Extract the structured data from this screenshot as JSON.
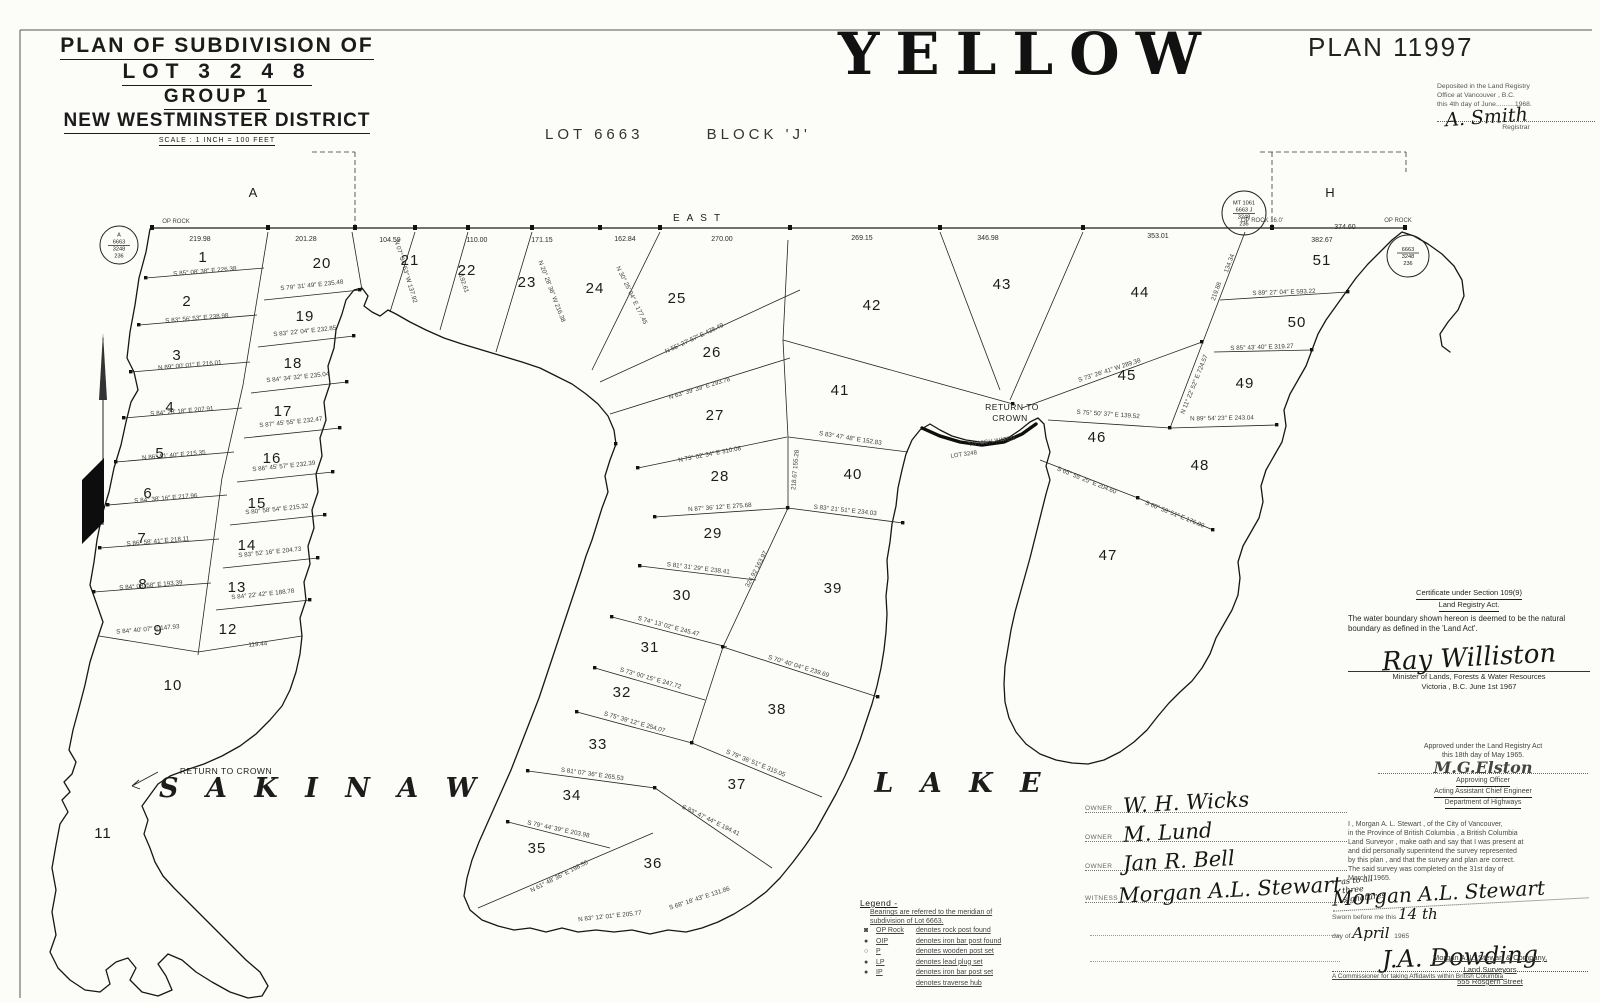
{
  "header": {
    "title_line1": "PLAN  OF  SUBDIVISION  OF",
    "title_line2": "LOT  3 2 4 8",
    "title_line3": "GROUP 1",
    "title_line4": "NEW WESTMINSTER DISTRICT",
    "scale": "SCALE : 1 INCH = 100 FEET",
    "big_title": "YELLOW",
    "plan_number": "PLAN 11997",
    "lot_label": "LOT  6663",
    "block_label": "BLOCK  'J'"
  },
  "deposit": {
    "line1": "Deposited in the Land Registry",
    "line2": "Office  at  Vancouver ,  B.C.",
    "line3": "this 4th day of June..........1968.",
    "signature": "A. Smith",
    "role": "Registrar"
  },
  "certificate": {
    "line1": "Certificate under Section 109(9)",
    "line2": "Land Registry Act.",
    "body": "The water boundary shown hereon is deemed to be the natural boundary as defined in the 'Land Act'.",
    "signature": "Ray Williston",
    "role1": "Minister of Lands, Forests & Water Resources",
    "location_date": "Victoria , B.C.        June 1st        1967"
  },
  "approval": {
    "line1": "Approved under the Land Registry Act",
    "line2": "this 18th day of May 1965.",
    "signature": "M.G.Elston",
    "role1": "Approving Officer",
    "role2": "Acting Assistant Chief Engineer",
    "role3": "Department of Highways"
  },
  "owners": {
    "rows": [
      {
        "label": "OWNER",
        "name": "W. H. Wicks",
        "note": ""
      },
      {
        "label": "OWNER",
        "name": "M. Lund",
        "note": ""
      },
      {
        "label": "OWNER",
        "name": "Jan R. Bell",
        "note": ""
      },
      {
        "label": "WITNESS",
        "name": "Morgan A.L. Stewart",
        "note": "as to all three signatures"
      }
    ]
  },
  "affidavit": {
    "lines": [
      "I , Morgan A. L. Stewart , of the City of  Vancouver,",
      "in the Province  of British Columbia , a British Columbia",
      "Land Surveyor , make oath and say  that I was present at",
      "and did personally  superintend  the  survey  represented",
      "by this plan , and that the survey and plan are correct.",
      "The said survey  was  completed  on  the  31st  day of",
      "March  ,  1965."
    ]
  },
  "sworn": {
    "surveyor_signature": "Morgan A.L. Stewart",
    "line1": "Sworn before me this ",
    "date_script": "14 th",
    "line2": "day of ",
    "month_script": "April",
    "year": " 1965",
    "signature": "J.A. Dowding",
    "commissioner": "A Commissioner for taking Affidavits within British Columbia"
  },
  "company": {
    "line1": "Morgan  A. L.  Stewart  &  Company,",
    "line2": "Land  Surveyors",
    "line3": "555   Rosgern   Street"
  },
  "legend": {
    "title": "Legend -",
    "note1": "Bearings are referred to the meridian of",
    "note2": "subdivision  of  Lot 6663.",
    "rows": [
      {
        "sym": "◙",
        "abbr": "OP Rock",
        "text": "denotes rock post found"
      },
      {
        "sym": "●",
        "abbr": "OIP",
        "text": "denotes iron bar post found"
      },
      {
        "sym": "○",
        "abbr": "P",
        "text": "denotes wooden post set"
      },
      {
        "sym": "●",
        "abbr": "LP",
        "text": "denotes lead plug set"
      },
      {
        "sym": "●",
        "abbr": "IP",
        "text": "denotes iron bar post set"
      },
      {
        "sym": "",
        "abbr": "",
        "text": "denotes traverse hub"
      }
    ]
  },
  "map": {
    "ink_color": "#1c1c1c",
    "paper_color": "#fcfcf9",
    "labels": [
      {
        "t": "EAST",
        "x": 700,
        "y": 221,
        "cls": "dir"
      },
      {
        "t": "A",
        "x": 253,
        "y": 197,
        "cls": "big"
      },
      {
        "t": "H",
        "x": 1330,
        "y": 197,
        "cls": "big"
      },
      {
        "t": "S A K I N A W",
        "x": 322,
        "y": 797,
        "cls": "lake"
      },
      {
        "t": "L A K E",
        "x": 962,
        "y": 792,
        "cls": "lake"
      },
      {
        "t": "RETURN TO CROWN",
        "x": 226,
        "y": 774,
        "cls": "rtc"
      },
      {
        "t": "RETURN TO",
        "x": 1012,
        "y": 410,
        "cls": "rtc"
      },
      {
        "t": "CROWN",
        "x": 1010,
        "y": 421,
        "cls": "rtc"
      },
      {
        "t": "TO HIGH WATER",
        "x": 992,
        "y": 443,
        "cls": "tiny",
        "r": -8
      },
      {
        "t": "LOT 3248",
        "x": 964,
        "y": 456,
        "cls": "tiny",
        "r": -8
      },
      {
        "t": "OP ROCK",
        "x": 176,
        "y": 223,
        "cls": "tiny"
      },
      {
        "t": "OP ROCK  16.0'",
        "x": 1262,
        "y": 222,
        "cls": "tiny"
      },
      {
        "t": "OP ROCK",
        "x": 1398,
        "y": 222,
        "cls": "tiny"
      }
    ],
    "lots": [
      {
        "n": 1,
        "x": 203,
        "y": 262
      },
      {
        "n": 2,
        "x": 187,
        "y": 306
      },
      {
        "n": 3,
        "x": 177,
        "y": 360
      },
      {
        "n": 4,
        "x": 170,
        "y": 412
      },
      {
        "n": 5,
        "x": 160,
        "y": 458
      },
      {
        "n": 6,
        "x": 148,
        "y": 498
      },
      {
        "n": 7,
        "x": 142,
        "y": 543
      },
      {
        "n": 8,
        "x": 143,
        "y": 589
      },
      {
        "n": 9,
        "x": 158,
        "y": 635
      },
      {
        "n": 10,
        "x": 173,
        "y": 690
      },
      {
        "n": 11,
        "x": 103,
        "y": 838
      },
      {
        "n": 12,
        "x": 228,
        "y": 634
      },
      {
        "n": 13,
        "x": 237,
        "y": 592
      },
      {
        "n": 14,
        "x": 247,
        "y": 550
      },
      {
        "n": 15,
        "x": 257,
        "y": 508
      },
      {
        "n": 16,
        "x": 272,
        "y": 463
      },
      {
        "n": 17,
        "x": 283,
        "y": 416
      },
      {
        "n": 18,
        "x": 293,
        "y": 368
      },
      {
        "n": 19,
        "x": 305,
        "y": 321
      },
      {
        "n": 20,
        "x": 322,
        "y": 268
      },
      {
        "n": 21,
        "x": 410,
        "y": 265
      },
      {
        "n": 22,
        "x": 467,
        "y": 275
      },
      {
        "n": 23,
        "x": 527,
        "y": 287
      },
      {
        "n": 24,
        "x": 595,
        "y": 293
      },
      {
        "n": 25,
        "x": 677,
        "y": 303
      },
      {
        "n": 26,
        "x": 712,
        "y": 357
      },
      {
        "n": 27,
        "x": 715,
        "y": 420
      },
      {
        "n": 28,
        "x": 720,
        "y": 481
      },
      {
        "n": 29,
        "x": 713,
        "y": 538
      },
      {
        "n": 30,
        "x": 682,
        "y": 600
      },
      {
        "n": 31,
        "x": 650,
        "y": 652
      },
      {
        "n": 32,
        "x": 622,
        "y": 697
      },
      {
        "n": 33,
        "x": 598,
        "y": 749
      },
      {
        "n": 34,
        "x": 572,
        "y": 800
      },
      {
        "n": 35,
        "x": 537,
        "y": 853
      },
      {
        "n": 36,
        "x": 653,
        "y": 868
      },
      {
        "n": 37,
        "x": 737,
        "y": 789
      },
      {
        "n": 38,
        "x": 777,
        "y": 714
      },
      {
        "n": 39,
        "x": 833,
        "y": 593
      },
      {
        "n": 40,
        "x": 853,
        "y": 479
      },
      {
        "n": 41,
        "x": 840,
        "y": 395
      },
      {
        "n": 42,
        "x": 872,
        "y": 310
      },
      {
        "n": 43,
        "x": 1002,
        "y": 289
      },
      {
        "n": 44,
        "x": 1140,
        "y": 297
      },
      {
        "n": 45,
        "x": 1127,
        "y": 380
      },
      {
        "n": 46,
        "x": 1097,
        "y": 442
      },
      {
        "n": 47,
        "x": 1108,
        "y": 560
      },
      {
        "n": 48,
        "x": 1200,
        "y": 470
      },
      {
        "n": 49,
        "x": 1245,
        "y": 388
      },
      {
        "n": 50,
        "x": 1297,
        "y": 327
      },
      {
        "n": 51,
        "x": 1322,
        "y": 265
      }
    ],
    "baseline_distances": [
      {
        "t": "219.98",
        "x": 200,
        "y": 241
      },
      {
        "t": "201.28",
        "x": 306,
        "y": 241
      },
      {
        "t": "104.59",
        "x": 390,
        "y": 242
      },
      {
        "t": "110.00",
        "x": 477,
        "y": 242
      },
      {
        "t": "171.15",
        "x": 542,
        "y": 242
      },
      {
        "t": "162.84",
        "x": 625,
        "y": 241
      },
      {
        "t": "270.00",
        "x": 722,
        "y": 241
      },
      {
        "t": "269.15",
        "x": 862,
        "y": 240
      },
      {
        "t": "346.98",
        "x": 988,
        "y": 240
      },
      {
        "t": "353.01",
        "x": 1158,
        "y": 238
      },
      {
        "t": "382.67",
        "x": 1322,
        "y": 242
      },
      {
        "t": "374.60",
        "x": 1345,
        "y": 229
      }
    ],
    "annotations": [
      {
        "t": "S 85° 08' 38″ E   226.38",
        "x": 205,
        "y": 273,
        "r": -5
      },
      {
        "t": "S 83° 56' 53″ E   238.98",
        "x": 197,
        "y": 320,
        "r": -5
      },
      {
        "t": "N 89° 00' 01″ E   216.01",
        "x": 190,
        "y": 367,
        "r": -5
      },
      {
        "t": "S 84° 28' 18″ E   207.91",
        "x": 182,
        "y": 413,
        "r": -5
      },
      {
        "t": "N 86° 51' 40″ E   215.35",
        "x": 174,
        "y": 457,
        "r": -5
      },
      {
        "t": "S 84° 38' 16″ E   217.96",
        "x": 166,
        "y": 500,
        "r": -5
      },
      {
        "t": "S 86° 58' 41″ E   218.11",
        "x": 158,
        "y": 543,
        "r": -5
      },
      {
        "t": "S 84° 08' 58″ E   193.39",
        "x": 151,
        "y": 587,
        "r": -5
      },
      {
        "t": "S 84° 40' 07″ E   147.93",
        "x": 148,
        "y": 631,
        "r": -5
      },
      {
        "t": "S 79° 31' 49″ E   235.48",
        "x": 312,
        "y": 287,
        "r": -6
      },
      {
        "t": "S 83° 22' 04″ E   232.85",
        "x": 305,
        "y": 333,
        "r": -6
      },
      {
        "t": "S 84° 34' 32″ E   235.04",
        "x": 298,
        "y": 379,
        "r": -6
      },
      {
        "t": "S 87° 45' 55″ E   232.47",
        "x": 291,
        "y": 424,
        "r": -6
      },
      {
        "t": "S 86° 45' 57″ E   232.39",
        "x": 284,
        "y": 468,
        "r": -6
      },
      {
        "t": "S 80° 58' 54″ E   215.32",
        "x": 277,
        "y": 511,
        "r": -6
      },
      {
        "t": "S 83° 52' 16″ E   204.73",
        "x": 270,
        "y": 554,
        "r": -6
      },
      {
        "t": "S 84° 22' 42″ E   188.78",
        "x": 263,
        "y": 596,
        "r": -6
      },
      {
        "t": "119.44",
        "x": 258,
        "y": 646,
        "r": -5
      },
      {
        "t": "N 07° 34' 53″ W  137.92",
        "x": 404,
        "y": 272,
        "r": 73
      },
      {
        "t": "192.61",
        "x": 462,
        "y": 284,
        "r": 71
      },
      {
        "t": "N 20° 28' 36″ W  216.38",
        "x": 550,
        "y": 292,
        "r": 69
      },
      {
        "t": "N 30° 25' 04″ E  177.45",
        "x": 630,
        "y": 296,
        "r": 64
      },
      {
        "t": "N 55° 27' 57″ E   438.49",
        "x": 695,
        "y": 340,
        "r": -25
      },
      {
        "t": "N 63° 39' 39″ E   293.78",
        "x": 700,
        "y": 390,
        "r": -17
      },
      {
        "t": "N 73° 02' 34″ E   310.08",
        "x": 710,
        "y": 456,
        "r": -11
      },
      {
        "t": "N 87° 36' 12″ E   275.68",
        "x": 720,
        "y": 509,
        "r": -4
      },
      {
        "t": "S 81° 31' 29″ E   238.41",
        "x": 698,
        "y": 570,
        "r": 7
      },
      {
        "t": "S 74° 13' 02″ E   245.47",
        "x": 668,
        "y": 628,
        "r": 15
      },
      {
        "t": "S 73° 00' 15″ E   247.72",
        "x": 650,
        "y": 680,
        "r": 16
      },
      {
        "t": "S 75° 39' 12″ E   254.07",
        "x": 634,
        "y": 724,
        "r": 16
      },
      {
        "t": "S 81° 07' 36″ E   265.53",
        "x": 592,
        "y": 776,
        "r": 8
      },
      {
        "t": "S 79° 44' 39″ E   203.98",
        "x": 558,
        "y": 831,
        "r": 12
      },
      {
        "t": "N 61° 48' 36″ E   198.56",
        "x": 560,
        "y": 878,
        "r": -27
      },
      {
        "t": "N 83° 12' 01″ E   205.77",
        "x": 610,
        "y": 918,
        "r": -6
      },
      {
        "t": "S 68° 18' 43″ E   131.86",
        "x": 700,
        "y": 900,
        "r": -18
      },
      {
        "t": "S 83° 47' 44″ E   194.41",
        "x": 710,
        "y": 822,
        "r": 26
      },
      {
        "t": "S 79° 36' 51″ E   315.05",
        "x": 755,
        "y": 765,
        "r": 22
      },
      {
        "t": "S 70° 40' 04″ E   239.69",
        "x": 798,
        "y": 668,
        "r": 17
      },
      {
        "t": "S 83° 21' 51″ E   234.03",
        "x": 845,
        "y": 512,
        "r": 6
      },
      {
        "t": "S 83° 47' 48″ E   152.83",
        "x": 850,
        "y": 440,
        "r": 9
      },
      {
        "t": "324.92   163.97",
        "x": 758,
        "y": 570,
        "r": -62
      },
      {
        "t": "218.67  155.28",
        "x": 797,
        "y": 470,
        "r": -85
      },
      {
        "t": "S 73° 26' 41″ W   289.38",
        "x": 1110,
        "y": 372,
        "r": -18
      },
      {
        "t": "S 75° 50' 37″ E   139.52",
        "x": 1108,
        "y": 416,
        "r": 4
      },
      {
        "t": "S 65° 55' 25″ E   204.60",
        "x": 1086,
        "y": 482,
        "r": 22
      },
      {
        "t": "S 60° 58' 51″ E   176.80",
        "x": 1174,
        "y": 516,
        "r": 22
      },
      {
        "t": "N 89° 54' 23″ E   243.04",
        "x": 1222,
        "y": 420,
        "r": -1
      },
      {
        "t": "S 85° 43' 40″ E   319.27",
        "x": 1262,
        "y": 349,
        "r": -2
      },
      {
        "t": "S 89° 27' 04″ E   593.22",
        "x": 1284,
        "y": 294,
        "r": -2
      },
      {
        "t": "N 11° 22' 52″ E   724.57",
        "x": 1196,
        "y": 385,
        "r": -68
      },
      {
        "t": "219.88",
        "x": 1218,
        "y": 292,
        "r": -70
      },
      {
        "t": "134.34",
        "x": 1231,
        "y": 264,
        "r": -70
      }
    ],
    "monuments": [
      {
        "x": 119,
        "y": 245,
        "r": 19,
        "bar": 1,
        "lines": [
          "A",
          "6663",
          "3248",
          "236"
        ]
      },
      {
        "x": 1244,
        "y": 213,
        "r": 22,
        "bar": 1,
        "lines": [
          "MT 1061",
          "6663 J",
          "3248",
          "236"
        ]
      },
      {
        "x": 1408,
        "y": 256,
        "r": 21,
        "bar": 0,
        "lines": [
          "6663",
          "3248",
          "236"
        ]
      }
    ]
  }
}
